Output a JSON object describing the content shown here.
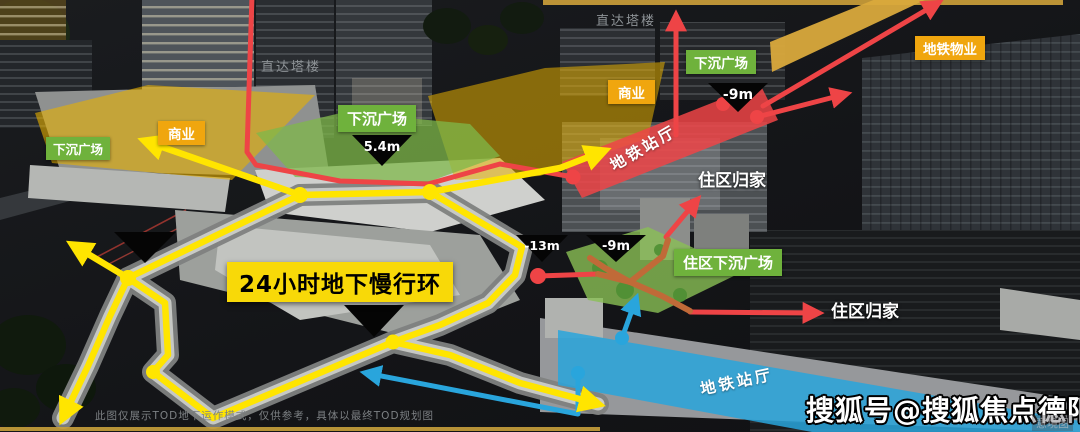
{
  "annotations": {
    "direct_tower_left": "直达塔楼",
    "direct_tower_right": "直达塔楼",
    "sunken_plaza_left": "下沉广场",
    "sunken_plaza_center": "下沉广场",
    "sunken_plaza_right": "下沉广场",
    "commercial_left": "商业",
    "commercial_right": "商业",
    "metro_property": "地铁物业",
    "metro_hall_upper": "地铁站厅",
    "metro_hall_lower": "地铁站厅",
    "home_upper": "住区归家",
    "home_lower": "住区归家",
    "residential_sunken_plaza": "住区下沉广场",
    "loop": "24小时地下慢行环"
  },
  "levels": {
    "plaza_center": "5.4m",
    "minus9_top": "-9m",
    "minus13_mid": "-13m",
    "minus9_mid": "-9m"
  },
  "footer": {
    "disclaimer": "此图仅展示TOD地下运作模式，仅供参考，具体以最终TOD规划图",
    "watermark": "搜狐号@搜狐焦点德阳站",
    "corner_mark": "意境图"
  },
  "colors": {
    "loop_yellow": "#ffe500",
    "zone_yellow": "#e8b000",
    "plaza_green": "#7fb84a",
    "tag_green": "#6fb23c",
    "tag_orange": "#f0a60e",
    "flow_red": "#ee4446",
    "flow_blue": "#29a5dc",
    "ramp_orange": "#c06a38",
    "gold_band": "#d9a93c",
    "label_yellow_bg": "#f8d908",
    "triangle_black": "#050505"
  }
}
